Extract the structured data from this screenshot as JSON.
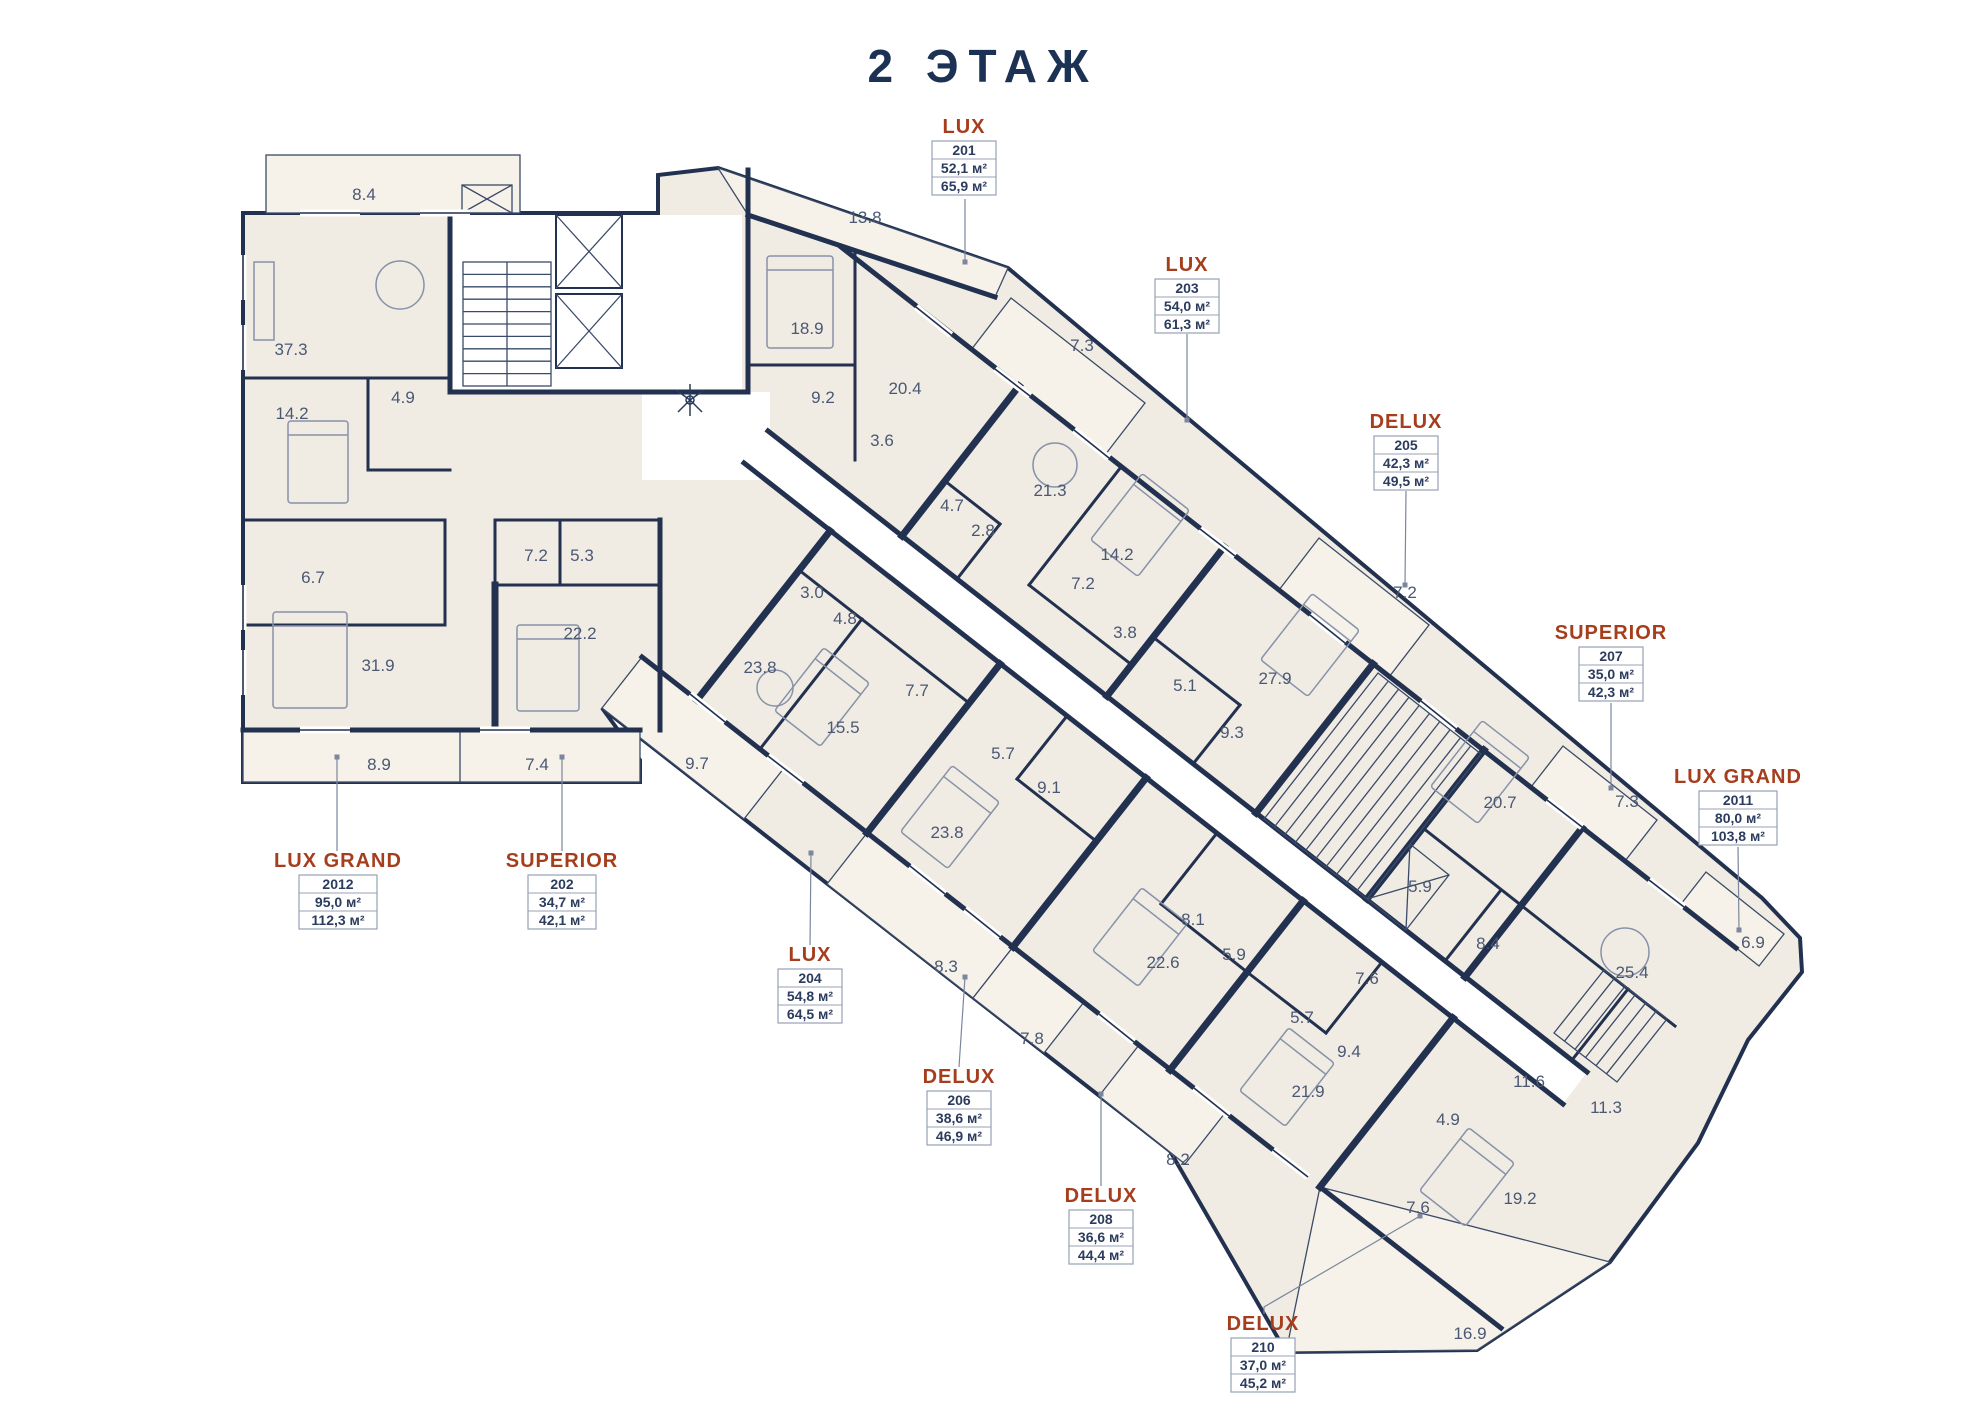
{
  "title": "2 ЭТАЖ",
  "colors": {
    "wall": "#22314f",
    "floor": "#f1ece3",
    "balcony": "#f6f2e9",
    "accent": "#a63e1e",
    "room_text": "#4a5874",
    "leader": "#7c879d",
    "box_border": "#97a2b6"
  },
  "units": [
    {
      "type": "LUX",
      "number": "201",
      "area": "52,1 м²",
      "total": "65,9 м²",
      "label": {
        "lx": 964,
        "ly": 133,
        "w": 64
      },
      "leader": [
        [
          965,
          262
        ],
        [
          965,
          199
        ]
      ]
    },
    {
      "type": "SUPERIOR",
      "number": "202",
      "area": "34,7 м²",
      "total": "42,1 м²",
      "label": {
        "lx": 562,
        "ly": 867,
        "w": 68
      },
      "leader": [
        [
          562,
          757
        ],
        [
          562,
          851
        ]
      ]
    },
    {
      "type": "LUX",
      "number": "203",
      "area": "54,0 м²",
      "total": "61,3 м²",
      "label": {
        "lx": 1187,
        "ly": 271,
        "w": 64
      },
      "leader": [
        [
          1187,
          420
        ],
        [
          1187,
          334
        ]
      ]
    },
    {
      "type": "LUX",
      "number": "204",
      "area": "54,8 м²",
      "total": "64,5 м²",
      "label": {
        "lx": 810,
        "ly": 961,
        "w": 64
      },
      "leader": [
        [
          811,
          853
        ],
        [
          810,
          945
        ]
      ]
    },
    {
      "type": "DELUX",
      "number": "205",
      "area": "42,3 м²",
      "total": "49,5 м²",
      "label": {
        "lx": 1406,
        "ly": 428,
        "w": 64
      },
      "leader": [
        [
          1405,
          585
        ],
        [
          1406,
          491
        ]
      ]
    },
    {
      "type": "DELUX",
      "number": "206",
      "area": "38,6 м²",
      "total": "46,9 м²",
      "label": {
        "lx": 959,
        "ly": 1083,
        "w": 64
      },
      "leader": [
        [
          965,
          977
        ],
        [
          959,
          1067
        ]
      ]
    },
    {
      "type": "SUPERIOR",
      "number": "207",
      "area": "35,0 м²",
      "total": "42,3 м²",
      "label": {
        "lx": 1611,
        "ly": 639,
        "w": 64
      },
      "leader": [
        [
          1611,
          788
        ],
        [
          1611,
          703
        ]
      ]
    },
    {
      "type": "DELUX",
      "number": "208",
      "area": "36,6 м²",
      "total": "44,4 м²",
      "label": {
        "lx": 1101,
        "ly": 1202,
        "w": 64
      },
      "leader": [
        [
          1101,
          1094
        ],
        [
          1101,
          1186
        ]
      ]
    },
    {
      "type": "DELUX",
      "number": "210",
      "area": "37,0 м²",
      "total": "45,2 м²",
      "label": {
        "lx": 1263,
        "ly": 1330,
        "w": 64
      },
      "leader": [
        [
          1420,
          1216
        ],
        [
          1264,
          1307
        ],
        [
          1264,
          1314
        ]
      ]
    },
    {
      "type": "LUX GRAND",
      "number": "2011",
      "area": "80,0 м²",
      "total": "103,8 м²",
      "label": {
        "lx": 1738,
        "ly": 783,
        "w": 78
      },
      "leader": [
        [
          1739,
          930
        ],
        [
          1738,
          847
        ]
      ]
    },
    {
      "type": "LUX GRAND",
      "number": "2012",
      "area": "95,0 м²",
      "total": "112,3 м²",
      "label": {
        "lx": 338,
        "ly": 867,
        "w": 78
      },
      "leader": [
        [
          337,
          757
        ],
        [
          337,
          851
        ]
      ]
    }
  ],
  "rooms": [
    {
      "v": "8.4",
      "x": 364,
      "y": 194
    },
    {
      "v": "37.3",
      "x": 291,
      "y": 349
    },
    {
      "v": "4.9",
      "x": 403,
      "y": 397
    },
    {
      "v": "14.2",
      "x": 292,
      "y": 413
    },
    {
      "v": "6.7",
      "x": 313,
      "y": 577
    },
    {
      "v": "31.9",
      "x": 378,
      "y": 665
    },
    {
      "v": "7.2",
      "x": 536,
      "y": 555
    },
    {
      "v": "5.3",
      "x": 582,
      "y": 555
    },
    {
      "v": "22.2",
      "x": 580,
      "y": 633
    },
    {
      "v": "8.9",
      "x": 379,
      "y": 764
    },
    {
      "v": "7.4",
      "x": 537,
      "y": 764
    },
    {
      "v": "9.7",
      "x": 697,
      "y": 763
    },
    {
      "v": "13.8",
      "x": 865,
      "y": 217
    },
    {
      "v": "18.9",
      "x": 807,
      "y": 328
    },
    {
      "v": "9.2",
      "x": 823,
      "y": 397
    },
    {
      "v": "20.4",
      "x": 905,
      "y": 388
    },
    {
      "v": "3.6",
      "x": 882,
      "y": 440
    },
    {
      "v": "7.3",
      "x": 1082,
      "y": 345
    },
    {
      "v": "21.3",
      "x": 1050,
      "y": 490
    },
    {
      "v": "4.7",
      "x": 952,
      "y": 505
    },
    {
      "v": "2.8",
      "x": 983,
      "y": 530
    },
    {
      "v": "14.2",
      "x": 1117,
      "y": 554
    },
    {
      "v": "7.2",
      "x": 1083,
      "y": 583
    },
    {
      "v": "3.8",
      "x": 1125,
      "y": 632
    },
    {
      "v": "7.2",
      "x": 1405,
      "y": 592
    },
    {
      "v": "27.9",
      "x": 1275,
      "y": 678
    },
    {
      "v": "5.1",
      "x": 1185,
      "y": 685
    },
    {
      "v": "9.3",
      "x": 1232,
      "y": 732
    },
    {
      "v": "20.7",
      "x": 1500,
      "y": 802
    },
    {
      "v": "7.3",
      "x": 1627,
      "y": 801
    },
    {
      "v": "5.9",
      "x": 1420,
      "y": 886
    },
    {
      "v": "8.4",
      "x": 1488,
      "y": 943
    },
    {
      "v": "25.4",
      "x": 1632,
      "y": 972
    },
    {
      "v": "6.9",
      "x": 1753,
      "y": 942
    },
    {
      "v": "11.6",
      "x": 1529,
      "y": 1081
    },
    {
      "v": "11.3",
      "x": 1606,
      "y": 1107
    },
    {
      "v": "4.9",
      "x": 1448,
      "y": 1119
    },
    {
      "v": "7.6",
      "x": 1418,
      "y": 1207
    },
    {
      "v": "19.2",
      "x": 1520,
      "y": 1198
    },
    {
      "v": "16.9",
      "x": 1470,
      "y": 1333
    },
    {
      "v": "3.0",
      "x": 812,
      "y": 592
    },
    {
      "v": "4.8",
      "x": 845,
      "y": 618
    },
    {
      "v": "7.7",
      "x": 917,
      "y": 690
    },
    {
      "v": "23.8",
      "x": 760,
      "y": 667
    },
    {
      "v": "15.5",
      "x": 843,
      "y": 727
    },
    {
      "v": "5.7",
      "x": 1003,
      "y": 753
    },
    {
      "v": "9.1",
      "x": 1049,
      "y": 787
    },
    {
      "v": "23.8",
      "x": 947,
      "y": 832
    },
    {
      "v": "8.3",
      "x": 946,
      "y": 966
    },
    {
      "v": "7.8",
      "x": 1032,
      "y": 1038
    },
    {
      "v": "8.1",
      "x": 1193,
      "y": 919
    },
    {
      "v": "22.6",
      "x": 1163,
      "y": 962
    },
    {
      "v": "5.9",
      "x": 1234,
      "y": 954
    },
    {
      "v": "5.7",
      "x": 1302,
      "y": 1017
    },
    {
      "v": "9.4",
      "x": 1349,
      "y": 1051
    },
    {
      "v": "21.9",
      "x": 1308,
      "y": 1091
    },
    {
      "v": "8.2",
      "x": 1178,
      "y": 1159
    },
    {
      "v": "7.6",
      "x": 1367,
      "y": 978
    }
  ]
}
